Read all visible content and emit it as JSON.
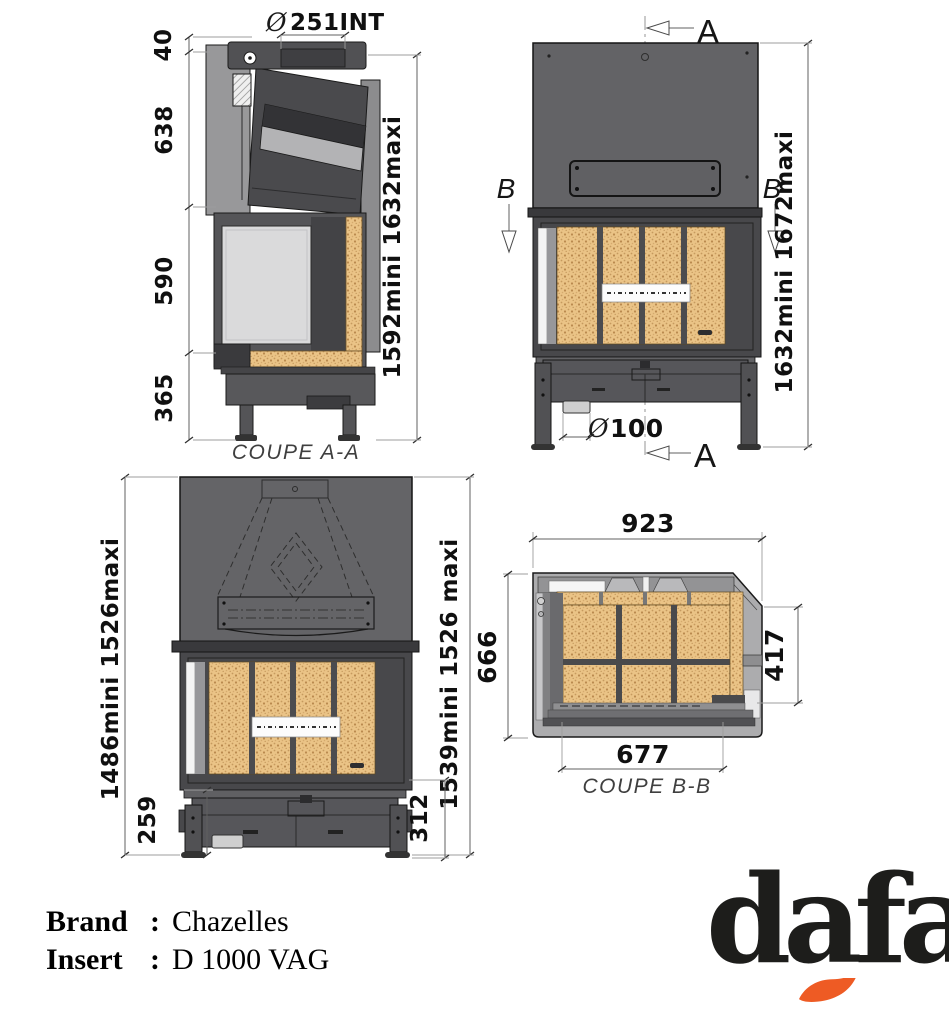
{
  "colors": {
    "body_dark": "#48484b",
    "hood_gray": "#636366",
    "casing_light": "#acacae",
    "firebrick": "#eac386",
    "glass": "#dadadb",
    "flame_accent": "#ee5b24",
    "ink": "#141414"
  },
  "views": {
    "coupe_aa": {
      "caption": "COUPE A-A",
      "flue_prefix": "Ø",
      "flue_value": "251INT",
      "height_top": "40",
      "height_upper": "638",
      "height_door": "590",
      "height_base": "365",
      "height_overall": "1592mini 1632maxi"
    },
    "front_upper": {
      "section_a_top": "A",
      "section_a_bottom": "A",
      "section_b_left": "B",
      "section_b_right": "B",
      "height_overall": "1632mini 1672maxi",
      "air_inlet_prefix": "Ø",
      "air_inlet_value": "100"
    },
    "front_lower": {
      "height_left": "1486mini 1526maxi",
      "height_right": "1539mini 1526 maxi",
      "base_left": "259",
      "base_right": "312"
    },
    "coupe_bb": {
      "caption": "COUPE B-B",
      "width_overall": "923",
      "depth_overall": "666",
      "depth_interior": "417",
      "width_interior": "677"
    }
  },
  "info": {
    "brand_label": "Brand",
    "brand_colon": ":",
    "brand_value": "Chazelles",
    "insert_label": "Insert",
    "insert_colon": ":",
    "insert_value": "D 1000 VAG"
  },
  "logo": {
    "wordmark": "dafa"
  }
}
